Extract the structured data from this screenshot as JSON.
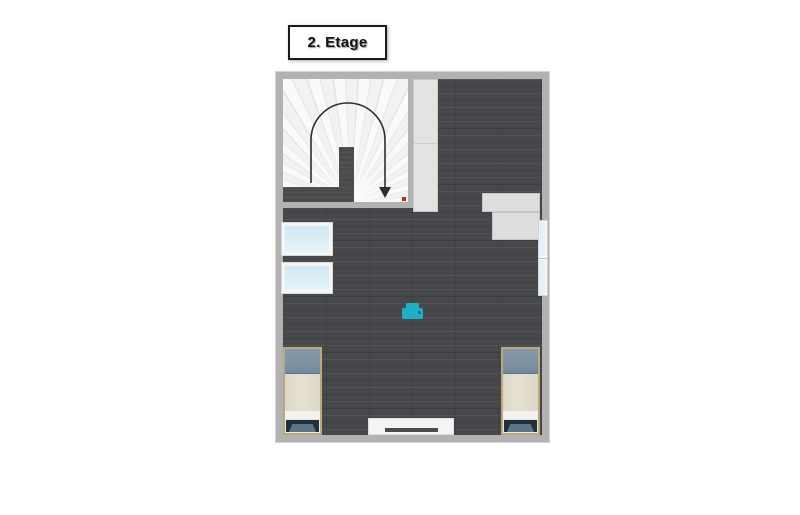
{
  "floor_label": {
    "text": "2. Etage"
  },
  "theme": {
    "canvas-bg": "#ffffff",
    "wall": "#b2b2b2",
    "wall-outline": "#d4d4d4",
    "floor-dark": "#47484b",
    "stair-wall": "#4a4b4d",
    "fan-light": "#fafafa",
    "fan-dark": "#e4e4e4",
    "arrow": "#2e2e2e",
    "marker-red": "#d02418",
    "wardrobe": "#e3e3e1",
    "shelf": "#dedede",
    "glass-frame": "#f6f6f6",
    "glass": "#d9ecf6",
    "bed-frame": "#bba87e",
    "bed-pillow": "#7e93a3",
    "bed-blanket": "#e7e1d0",
    "bed-sheet": "#f3f2ee",
    "bed-foot": "#5c7486",
    "bed-foot-dark": "#212f3b",
    "dresser": "#f4f4f4",
    "dresser-bar": "#4b4b4b",
    "printer": "#1eafc4",
    "printer-dark": "#0e6b7a",
    "label-border": "#1a1a1a",
    "label-text": "#111111"
  },
  "icons": {
    "printer": "printer-top-view",
    "stair_direction": "u-turn-arrow-down",
    "marker": "red-dot"
  },
  "objects": [
    "winder-staircase-with-direction-arrow",
    "wardrobe-tall",
    "shelf-upper",
    "shelf-lower",
    "window-right-wall-two-panes",
    "skylight-window-1",
    "skylight-window-2",
    "printer",
    "bed-left-single",
    "bed-right-single",
    "dresser-bottom-wall"
  ]
}
